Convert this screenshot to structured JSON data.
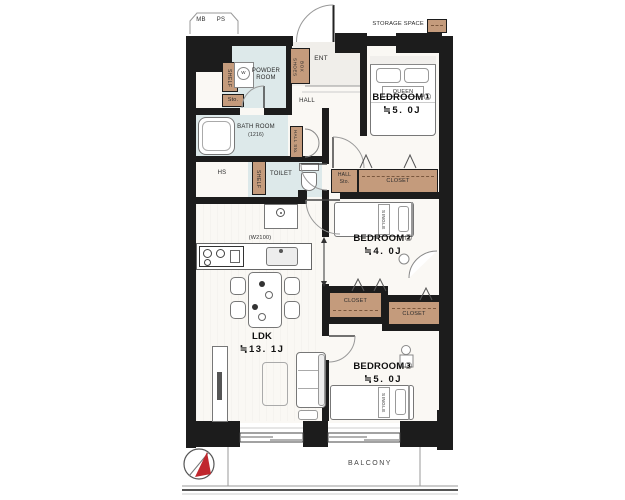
{
  "exterior": {
    "mb": "MB",
    "ps": "PS",
    "storage_space": "STORAGE SPACE",
    "balcony": "BALCONY"
  },
  "entry": {
    "ent": "ENT",
    "hall": "HALL",
    "shoes_box": "SHOES\nBOX"
  },
  "wet_area": {
    "powder_room": "POWDER\nROOM",
    "washer": "W",
    "shelf_upper": "SHELF",
    "sto": "Sto.",
    "bath_room": "BATH ROOM",
    "bath_size": "(1216)",
    "hall_sto_vertical": "HALL Sto.",
    "hs": "HS",
    "shelf_lower": "SHELF",
    "toilet": "TOILET"
  },
  "storage": {
    "hall_sto": "HALL\nSto.",
    "closet_bedroom1": "CLOSET",
    "closet_bedroom2": "CLOSET",
    "closet_bedroom3": "CLOSET"
  },
  "rooms": {
    "bedroom1": {
      "label": "BEDROOM①",
      "size": "≒5. 0J",
      "bed": "QUEEN"
    },
    "bedroom2": {
      "label": "BEDROOM②",
      "size": "≒4. 0J",
      "bed": "SINGLE"
    },
    "bedroom3": {
      "label": "BEDROOM③",
      "size": "≒5. 0J",
      "bed": "SINGLE"
    },
    "ldk": {
      "label": "LDK",
      "size": "≒13. 1J",
      "kitchen_width": "(W2100)"
    }
  },
  "colors": {
    "wall": "#1c1c1c",
    "wet_room": "#dde9ea",
    "storage_tan": "#c49b7c",
    "compass_red": "#c0272d"
  }
}
